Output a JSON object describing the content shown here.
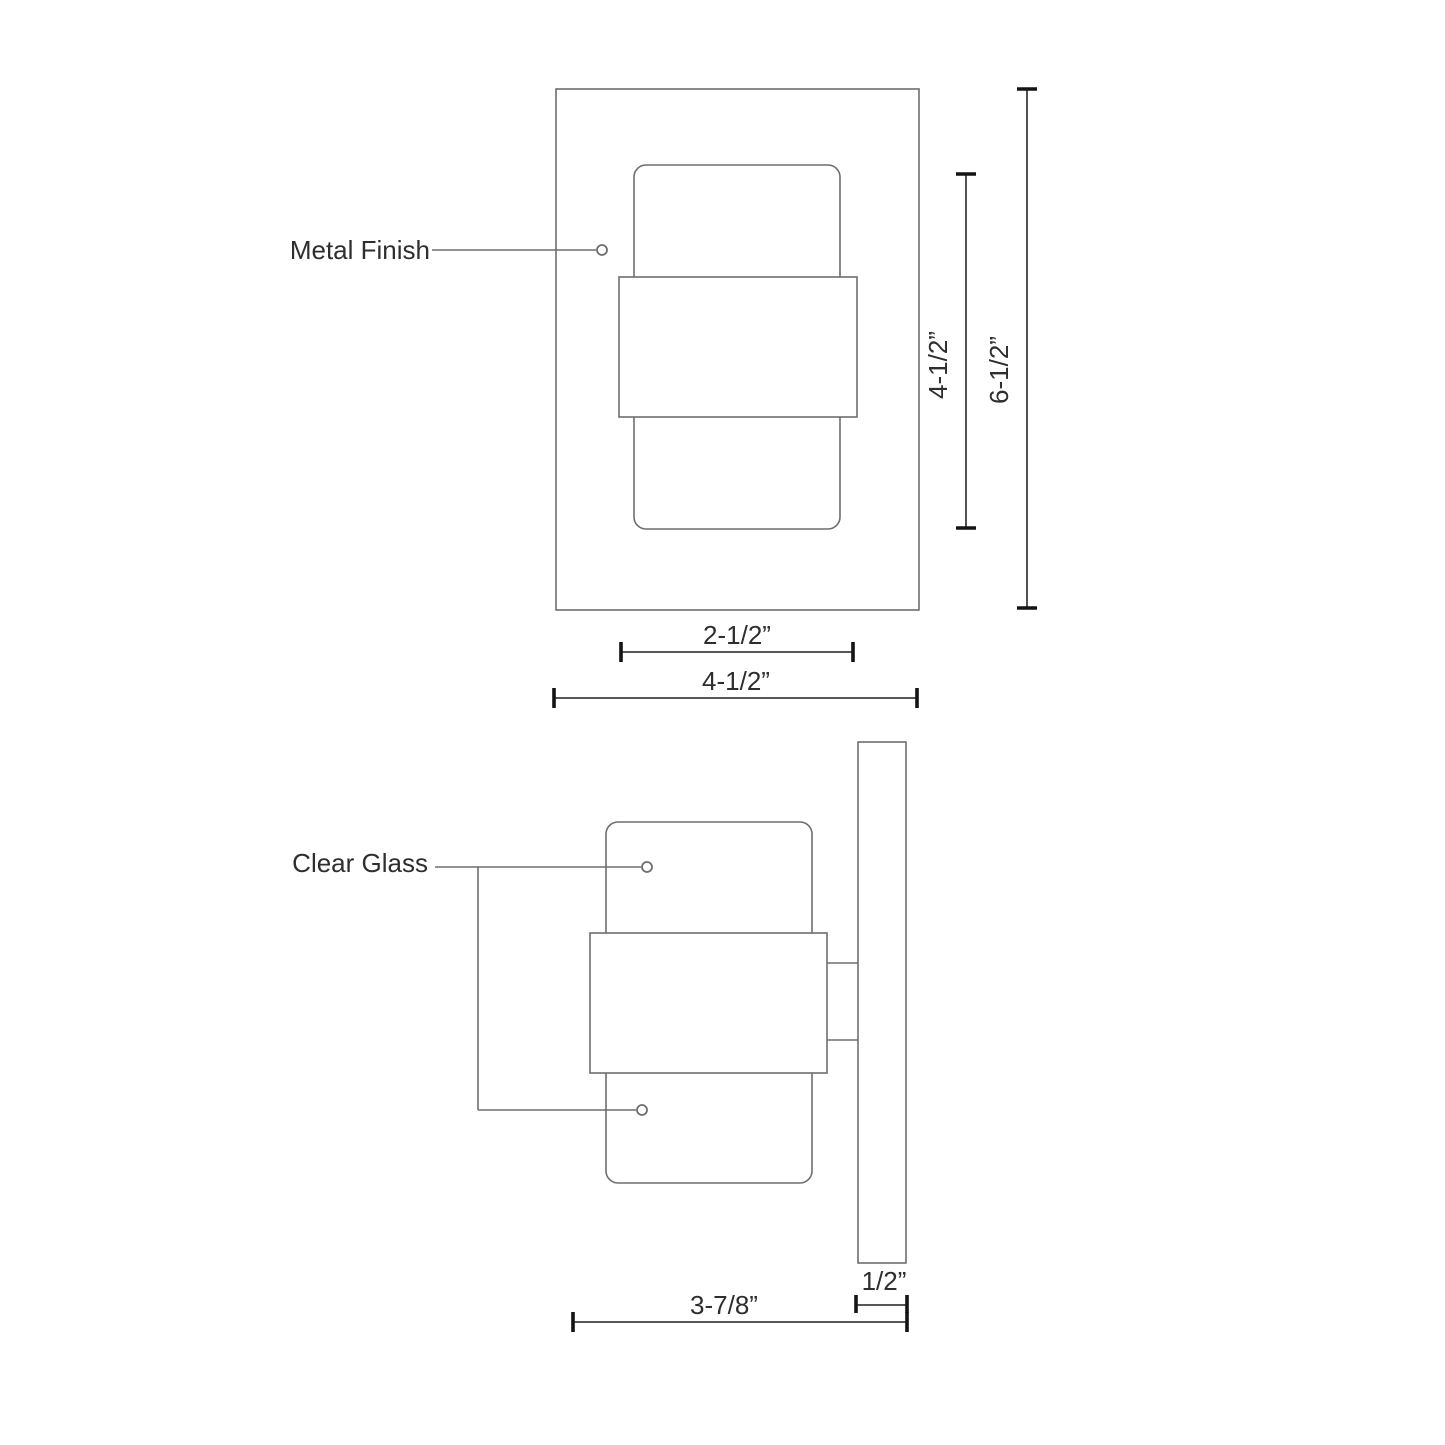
{
  "colors": {
    "background": "#ffffff",
    "outline_line": "#6e6e6e",
    "dimension_line": "#3f3f3f",
    "tick": "#141414",
    "text": "#2e2e2e"
  },
  "front_view": {
    "metal_finish_label": "Metal Finish",
    "dim_glass_height": "4-1/2”",
    "dim_overall_height": "6-1/2”",
    "dim_band_width": "2-1/2”",
    "dim_overall_width": "4-1/2”"
  },
  "side_view": {
    "clear_glass_label": "Clear Glass",
    "dim_depth": "3-7/8”",
    "dim_backplate_depth": "1/2”"
  }
}
